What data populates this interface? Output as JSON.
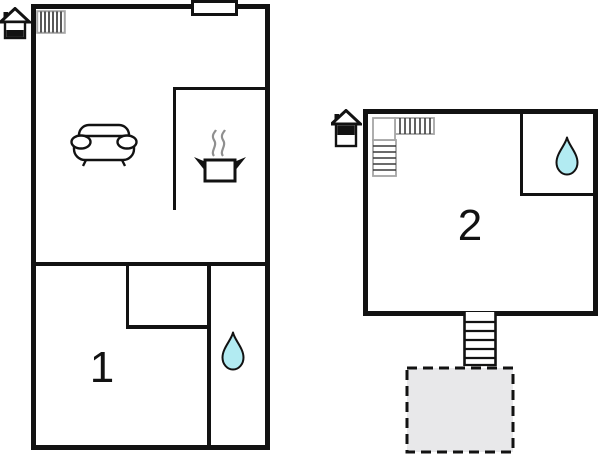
{
  "canvas": {
    "width": 600,
    "height": 454
  },
  "colors": {
    "background": "#ffffff",
    "wall": "#121212",
    "drop_fill": "#b2ebf2",
    "terrace_fill": "#e8e8ea",
    "icon_border": "#a6a6a6",
    "icon_stripe": "#3a3a3a",
    "steam": "#8f8f8f"
  },
  "units": [
    {
      "label": "1",
      "floor_indicator": "ground-floor",
      "icons": [
        "entrance-house-icon",
        "staircase-icon",
        "sofa-icon",
        "cooking-pot-icon",
        "water-drop-icon",
        "chimney-block"
      ]
    },
    {
      "label": "2",
      "floor_indicator": "upper-floor",
      "icons": [
        "entrance-house-icon",
        "l-shaped-staircase-icon",
        "water-drop-icon",
        "external-stairs-icon",
        "terrace-dashed-area"
      ]
    }
  ]
}
